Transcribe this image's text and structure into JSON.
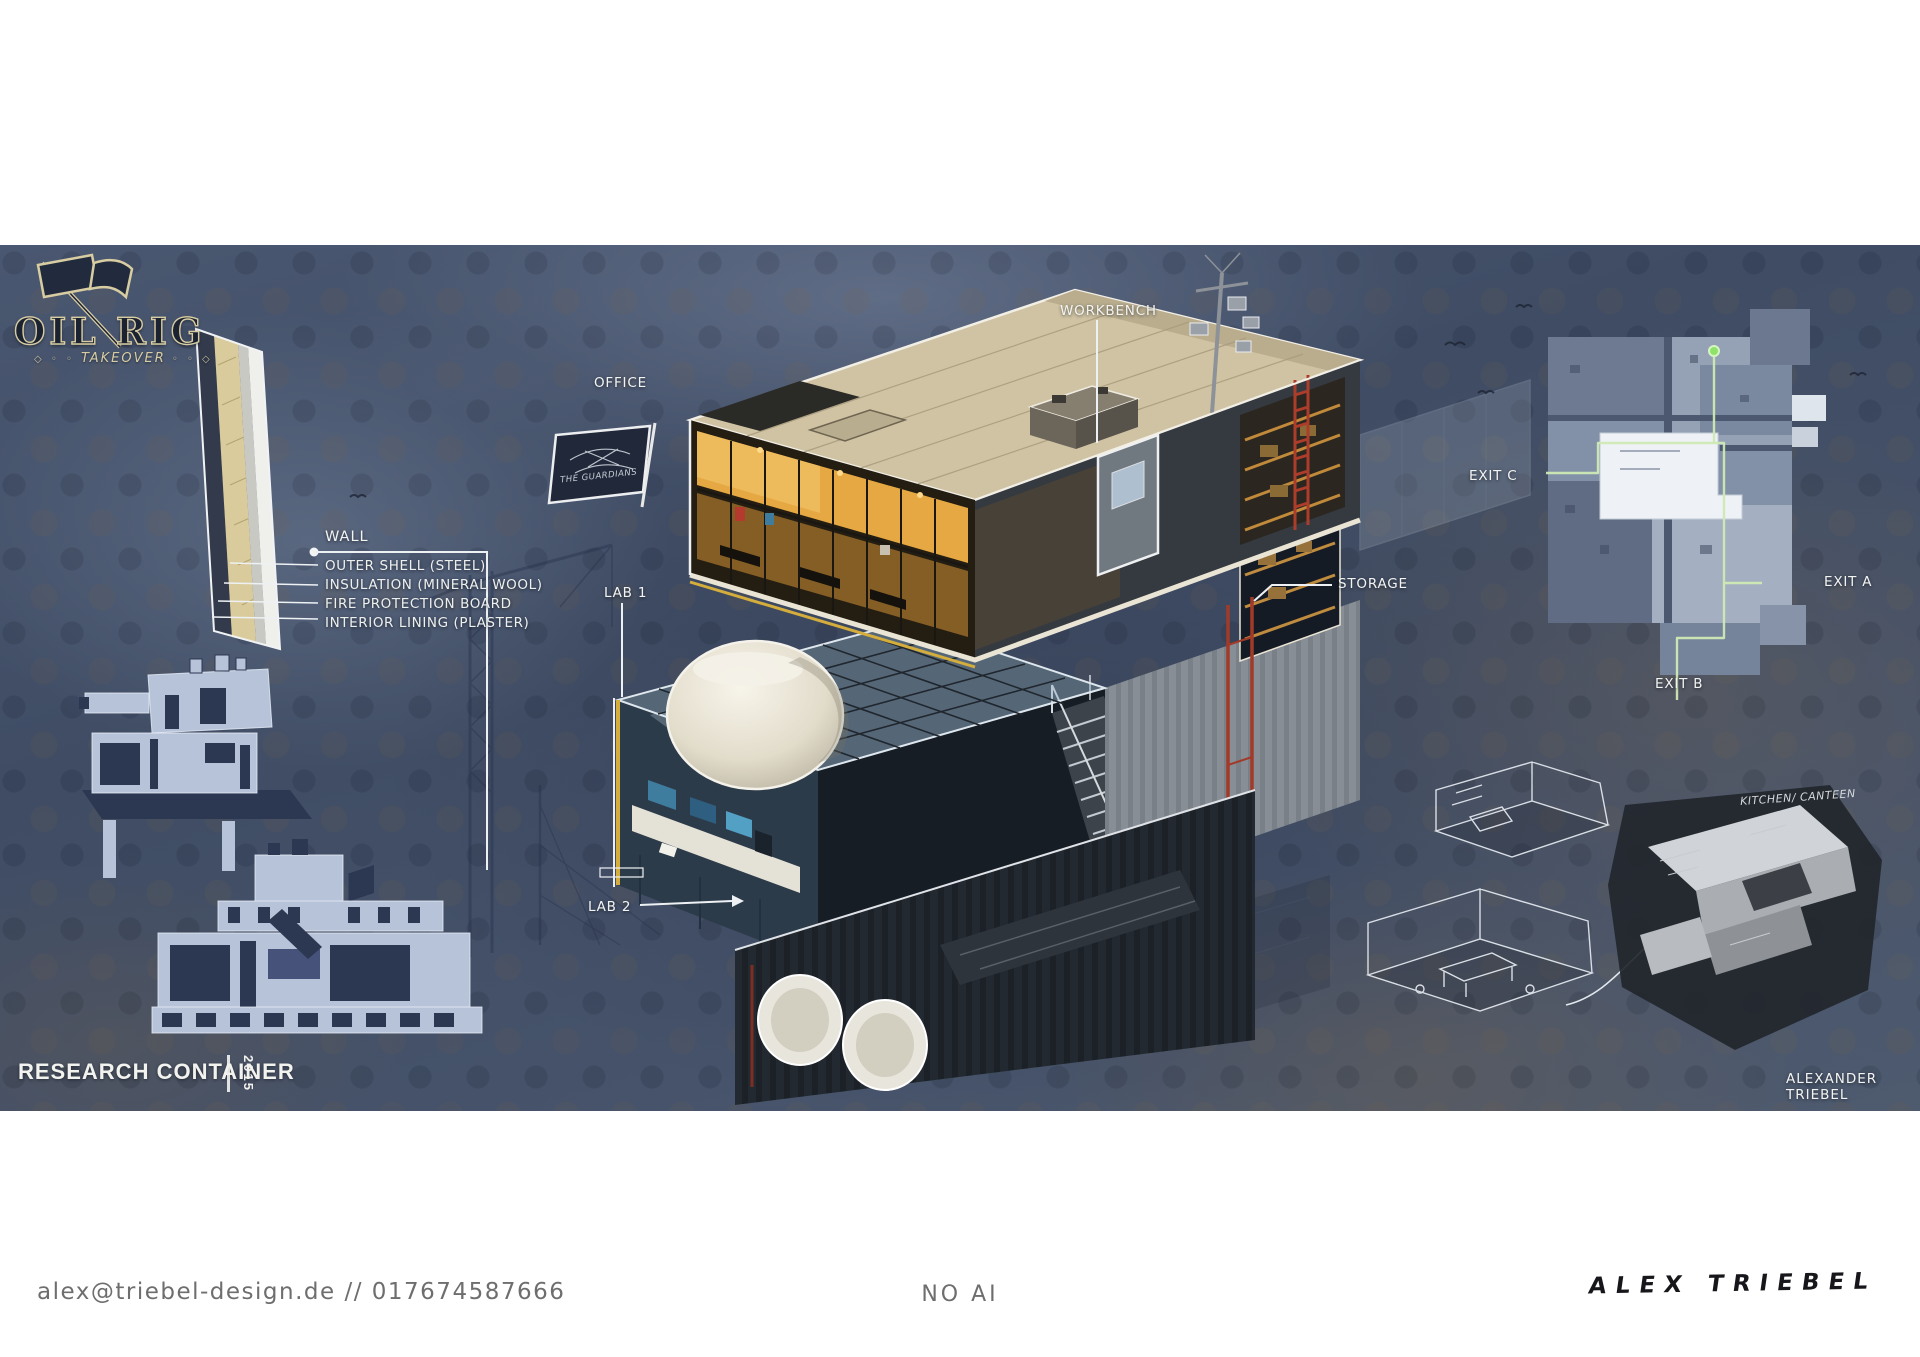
{
  "logo": {
    "title": "OIL RIG",
    "subtitle": "TAKEOVER",
    "ornament_left": "◇ ◦ ◦",
    "ornament_right": "◦ ◦ ◇"
  },
  "wall_section": {
    "title": "WALL",
    "layers": [
      "OUTER SHELL (STEEL)",
      "INSULATION (MINERAL WOOL)",
      "FIRE PROTECTION BOARD",
      "INTERIOR LINING (PLASTER)"
    ]
  },
  "callouts": {
    "office": "OFFICE",
    "workbench": "WORKBENCH",
    "lab_1": "LAB 1",
    "lab_2": "LAB 2",
    "storage": "STORAGE"
  },
  "floor_plan": {
    "exit_a": "EXIT A",
    "exit_b": "EXIT B",
    "exit_c": "EXIT C"
  },
  "flag": {
    "label": "THE GUARDIANS"
  },
  "sketch_note": "KITCHEN/ CANTEEN",
  "footer": {
    "project": "RESEARCH CONTAINER",
    "year": "2015",
    "author": "ALEXANDER TRIEBEL"
  },
  "bottom_bar": {
    "contact": "alex@triebel-design.de // 017674587666",
    "center_note": "NO AI",
    "signature": "ALEX TRIEBEL"
  },
  "colors": {
    "background": "#46536a",
    "roof_cream": "#cfc3a3",
    "warm_interior": "#e5a843",
    "accent_red": "#a23a29",
    "accent_yellow": "#d4ad3c",
    "accent_green": "#8fe36a",
    "label_text": "#f3f4f2"
  }
}
